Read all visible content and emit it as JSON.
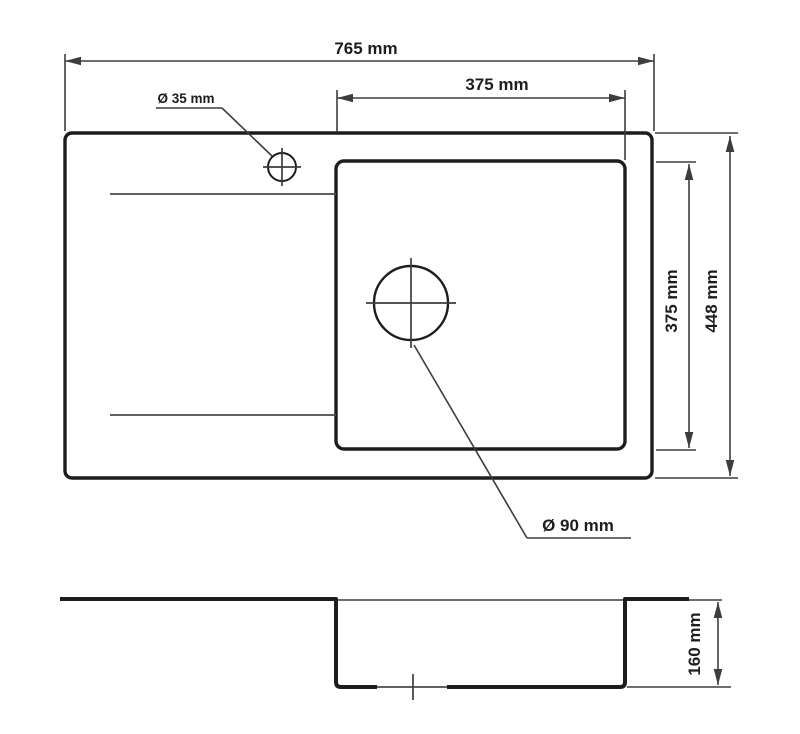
{
  "diagram": {
    "type": "technical-drawing",
    "subject": "kitchen sink dimensions, top view and section view",
    "top_view": {
      "overall_width_label": "765 mm",
      "overall_depth_label": "448 mm",
      "bowl_width_label": "375 mm",
      "bowl_height_label": "375 mm",
      "faucet_hole_label": "Ø 35 mm",
      "drain_hole_label": "Ø 90 mm"
    },
    "section_view": {
      "bowl_depth_label": "160 mm"
    },
    "colors": {
      "line-thick": "#1d1d1d",
      "line-thin": "#3d3d3d",
      "bg": "#ffffff"
    }
  }
}
